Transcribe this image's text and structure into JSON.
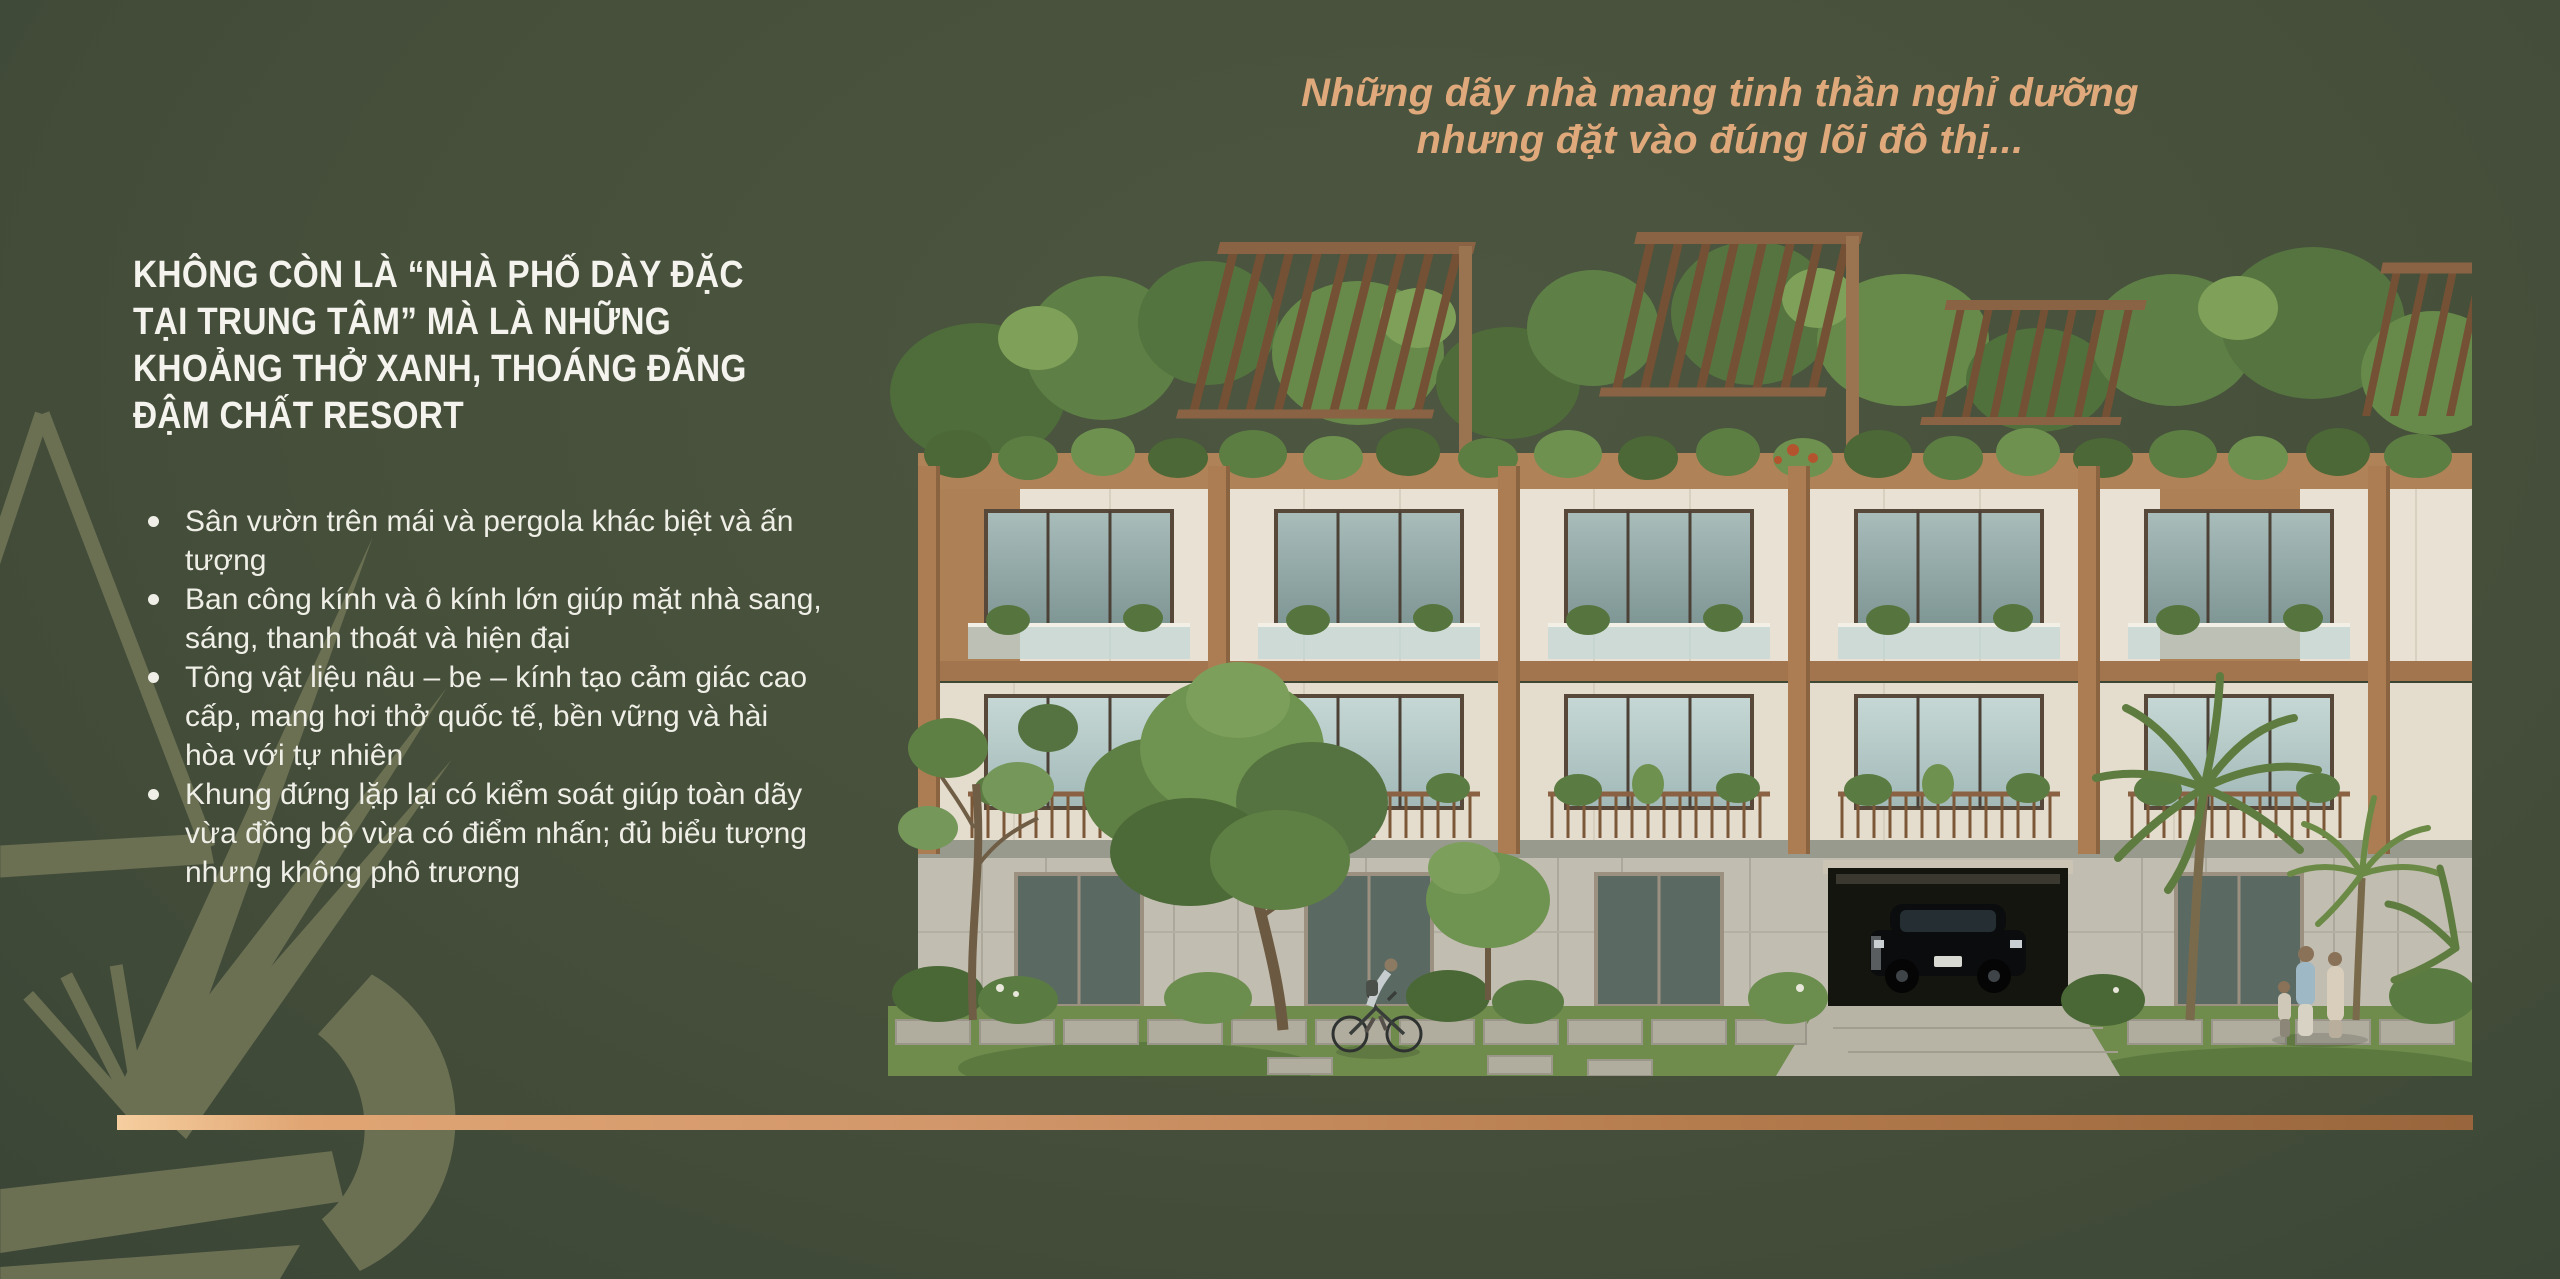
{
  "palette": {
    "bg_light": "#4C5640",
    "bg_mid": "#454F3A",
    "bg_dark": "#3B4536",
    "olive": "#6B7053",
    "tan": "#DFA97B",
    "text_light": "#F4F3ED",
    "text_soft": "#EFEEE7",
    "copper_light": "#E0A573",
    "copper_dark": "#98653C"
  },
  "tagline": {
    "line1": "Những dãy nhà mang tinh thần nghỉ dưỡng",
    "line2": "nhưng đặt vào đúng lõi đô thị..."
  },
  "headline": {
    "lines": [
      "KHÔNG CÒN LÀ “NHÀ PHỐ DÀY ĐẶC",
      "TẠI TRUNG TÂM” MÀ LÀ NHỮNG",
      "KHOẢNG THỞ XANH, THOÁNG ĐÃNG",
      "ĐẬM CHẤT RESORT"
    ]
  },
  "bullets": [
    "Sân vườn trên mái và pergola khác biệt và ấn tượng",
    "Ban công kính và ô kính lớn giúp mặt nhà sang, sáng, thanh thoát và hiện đại",
    "Tông vật liệu nâu – be – kính tạo cảm giác cao cấp, mang hơi thở quốc tế, bền vững và hài hòa với tự nhiên",
    "Khung đứng lặp lại có kiểm soát giúp toàn dãy vừa đồng bộ vừa có điểm nhấn; đủ biểu tượng nhưng không phô trương"
  ],
  "hero_image": {
    "alt": "Phối cảnh dãy nhà phố 3 tầng phong cách resort: sân vườn trên mái với pergola, ban công kính, tông vật liệu nâu – be – kính, cây xanh, người đi xe đạp và gia đình đi dạo, xe hơi đen trong garage"
  }
}
